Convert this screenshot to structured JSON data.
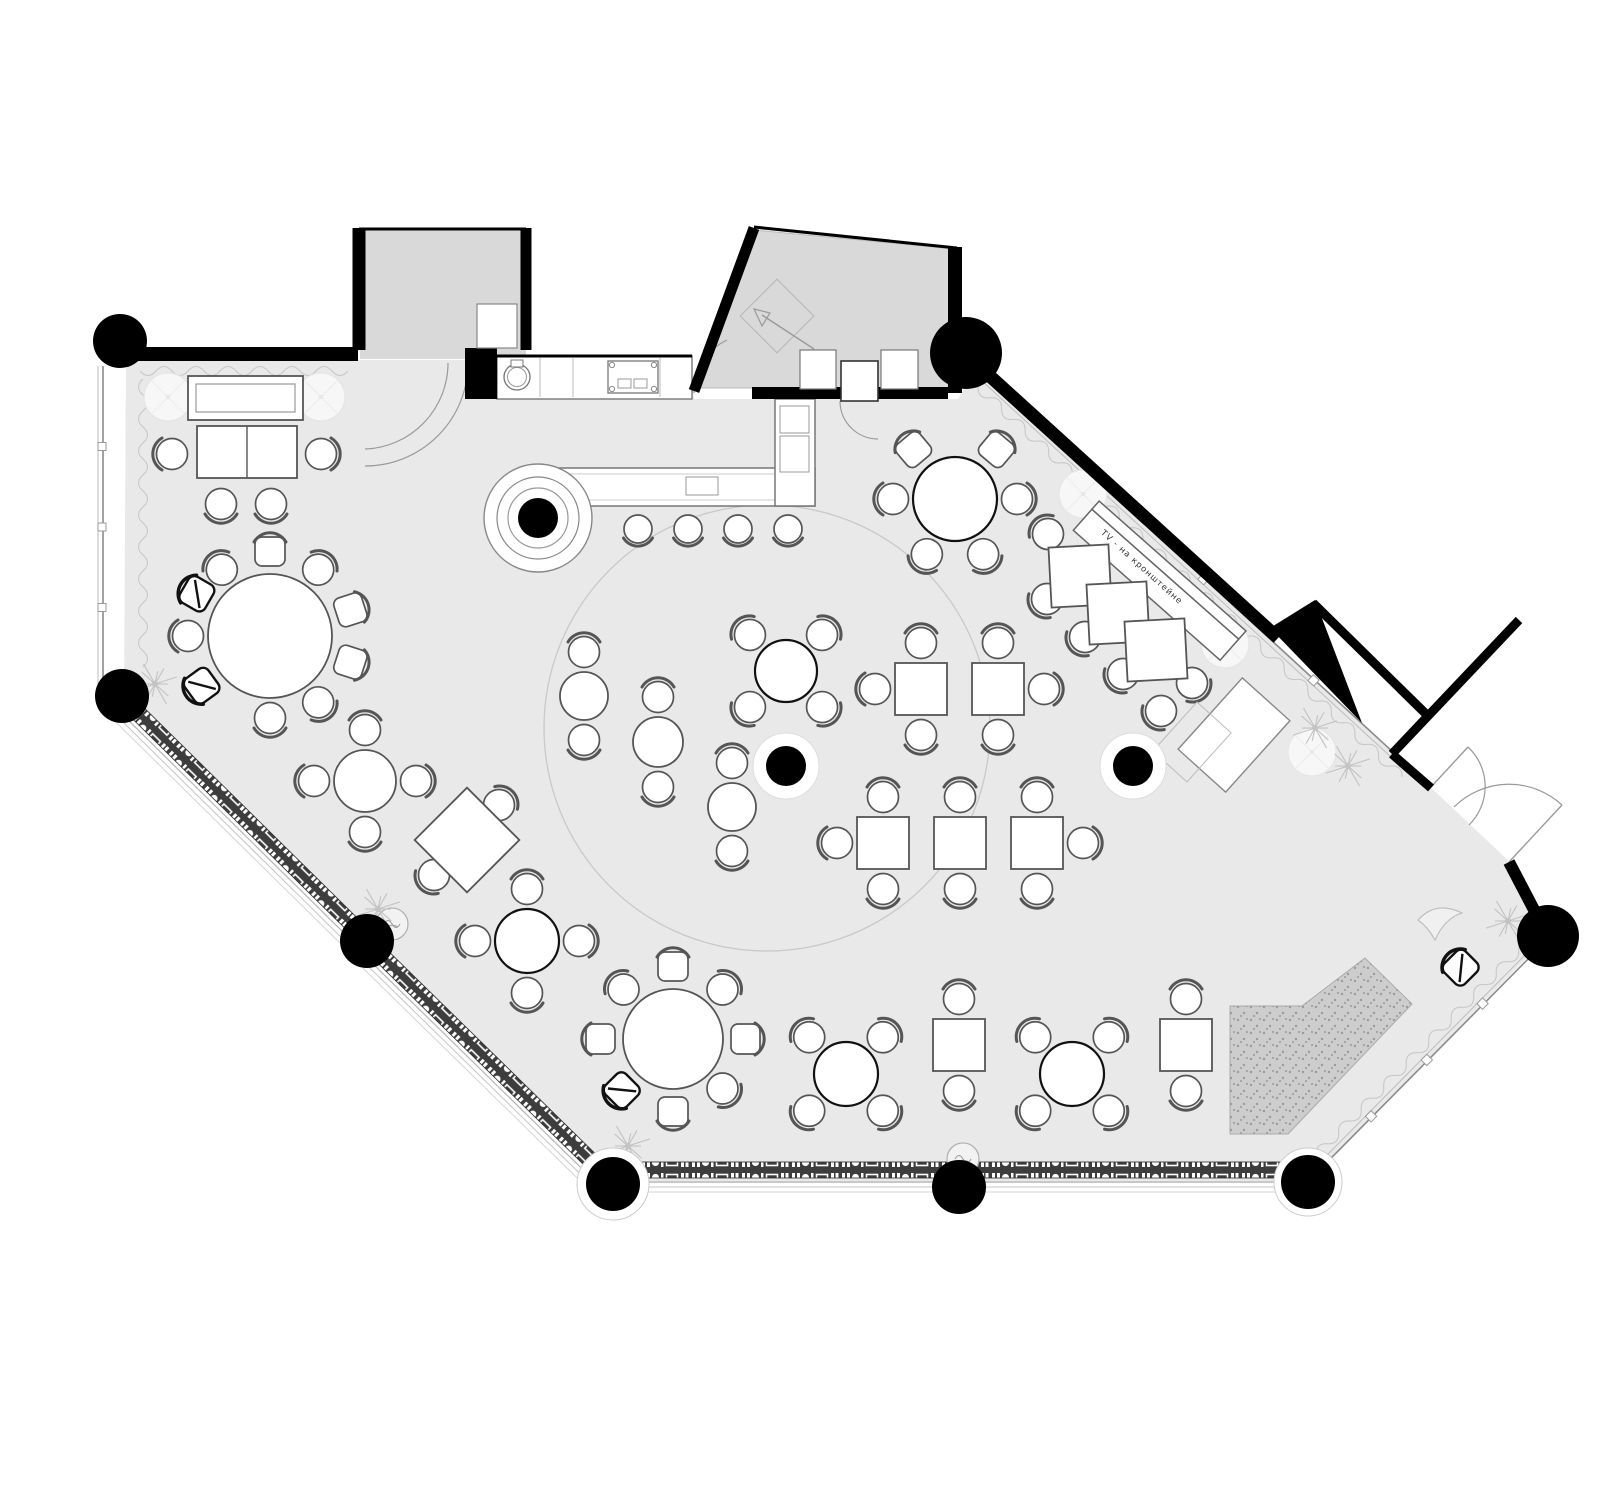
{
  "meta": {
    "title": "Restaurant floor plan",
    "canvas_w": 1600,
    "canvas_h": 1453
  },
  "labels": {
    "tv_mount": "TV - на кронштейне"
  },
  "colors": {
    "floor": "#e9e9e9",
    "recess": "#d9d9d9",
    "wall": "#000000",
    "stroke": "#555555",
    "bold_stroke": "#111111",
    "light": "#999999",
    "band_bg": "#3d3d3d",
    "stage_fill": "#cdcdcd",
    "stage_dot": "#9a9a9a",
    "dance": "#c9c9c9",
    "curtain": "#c8c8c8",
    "glass": "#8a8a8a",
    "faint": "#e5e5e5",
    "plant": "#c2c2c2"
  },
  "structure": {
    "floor_polygon": "86,344 652,344 654,383 918,383 938,350 1385,766 1472,848 1510,918 1268,1167 575,1167 84,678",
    "recess_alcove": "320,213 486,213 486,343 320,343",
    "recess_vestibule": "656,372 714,214 915,233 915,372",
    "walls": [
      [
        74,
        338,
        318,
        338,
        14
      ],
      [
        319,
        212,
        319,
        334,
        13
      ],
      [
        486,
        212,
        486,
        334,
        11
      ],
      [
        319,
        213,
        486,
        213,
        3
      ],
      [
        457,
        340,
        652,
        340,
        3
      ],
      [
        654,
        375,
        714,
        212,
        11
      ],
      [
        714,
        211,
        917,
        232,
        3
      ],
      [
        712,
        377,
        801,
        377,
        12
      ],
      [
        838,
        377,
        908,
        377,
        12
      ],
      [
        915,
        231,
        915,
        377,
        14
      ],
      [
        941,
        352,
        1238,
        622,
        13
      ],
      [
        1273,
        587,
        1386,
        698,
        9
      ],
      [
        1479,
        604,
        1352,
        738,
        9
      ],
      [
        1352,
        738,
        1391,
        772,
        9
      ],
      [
        1469,
        846,
        1503,
        911,
        12
      ]
    ],
    "wall_block": [
      425,
      332,
      32,
      51
    ],
    "wall_triangle": "1230,612 1275,584 1322,707",
    "columns": [
      [
        80,
        325,
        27
      ],
      [
        82,
        680,
        27
      ],
      [
        327,
        925,
        27
      ],
      [
        573,
        1168,
        27
      ],
      [
        919,
        1171,
        27
      ],
      [
        1268,
        1166,
        27
      ],
      [
        1508,
        920,
        31
      ],
      [
        926,
        337,
        36
      ]
    ],
    "ring_columns": [
      [
        746,
        750
      ],
      [
        1093,
        750
      ]
    ],
    "halo_columns": [
      [
        573,
        1168,
        36
      ],
      [
        1268,
        1166,
        34
      ]
    ],
    "glass": [
      {
        "x": 63,
        "y": 350,
        "angle": 90,
        "len": 322
      },
      {
        "x": 944,
        "y": 360,
        "angle": 42.6,
        "len": 598
      },
      {
        "x": 1499,
        "y": 932,
        "angle": 134.7,
        "len": 317
      }
    ],
    "curtains": [
      {
        "x": 100,
        "y": 355,
        "angle": 0,
        "len": 210
      },
      {
        "x": 103,
        "y": 363,
        "angle": 90,
        "len": 300
      },
      {
        "x": 938,
        "y": 371,
        "angle": 42.6,
        "len": 585
      },
      {
        "x": 1490,
        "y": 923,
        "angle": 134.7,
        "len": 310
      }
    ],
    "bands": [
      {
        "x": 600,
        "y": 1154,
        "angle": 0,
        "len": 645
      },
      {
        "x": 97,
        "y": 696,
        "angle": 44.6,
        "len": 303
      },
      {
        "x": 344,
        "y": 942,
        "angle": 44.4,
        "len": 295
      }
    ],
    "door_arcs": [
      {
        "d": "M428 347 A103 103 0 0 1 325 450"
      },
      {
        "d": "M408 347 A86 86 0 0 1 325 433"
      },
      {
        "d": "M654 377 A58 58 0 0 1 687 324"
      },
      {
        "d": "M800 385 A38 38 0 0 0 838 423"
      },
      {
        "d": "M1429 809 A54 54 0 0 0 1428 731",
        "leaf": [
          1391,
          771,
          1428,
          731
        ]
      },
      {
        "d": "M1414 791 A78 78 0 0 1 1522 789",
        "leaf": [
          1469,
          846,
          1522,
          789
        ]
      }
    ],
    "entry_mat": {
      "x": 737,
      "y": 300,
      "half": 26
    },
    "entry_arrow": {
      "line": [
        774,
        333,
        722,
        299
      ],
      "head": "714,293 730,297 722,310"
    },
    "door_leaf_rect": [
      801,
      345,
      37,
      40
    ],
    "benches": [
      [
        760,
        334,
        36,
        39
      ],
      [
        841,
        334,
        37,
        39
      ]
    ],
    "cabinet": [
      437,
      288,
      40,
      44
    ]
  },
  "furniture": {
    "round_tables": [
      {
        "x": 230,
        "y": 620,
        "r": 62,
        "bold": false,
        "seats": [
          [
            90,
            "s"
          ],
          [
            54,
            "c"
          ],
          [
            18,
            "s"
          ],
          [
            342,
            "s"
          ],
          [
            306,
            "c"
          ],
          [
            270,
            "c"
          ],
          [
            216,
            "b"
          ],
          [
            180,
            "c"
          ],
          [
            150,
            "b"
          ],
          [
            126,
            "c"
          ]
        ]
      },
      {
        "x": 915,
        "y": 483,
        "r": 42,
        "bold": true,
        "seats": [
          [
            130,
            "s"
          ],
          [
            50,
            "s"
          ],
          [
            180,
            "c"
          ],
          [
            0,
            "c"
          ],
          [
            243,
            "c"
          ],
          [
            297,
            "c"
          ]
        ]
      },
      {
        "x": 633,
        "y": 1023,
        "r": 50,
        "bold": false,
        "seats": [
          [
            90,
            "s"
          ],
          [
            45,
            "c"
          ],
          [
            0,
            "s"
          ],
          [
            315,
            "c"
          ],
          [
            270,
            "s"
          ],
          [
            225,
            "b"
          ],
          [
            180,
            "s"
          ],
          [
            135,
            "c"
          ]
        ]
      },
      {
        "x": 746,
        "y": 655,
        "r": 31,
        "bold": true,
        "seats": [
          [
            45,
            "c"
          ],
          [
            135,
            "c"
          ],
          [
            225,
            "c"
          ],
          [
            315,
            "c"
          ]
        ]
      },
      {
        "x": 806,
        "y": 1058,
        "r": 32,
        "bold": true,
        "seats": [
          [
            45,
            "c"
          ],
          [
            135,
            "c"
          ],
          [
            225,
            "c"
          ],
          [
            315,
            "c"
          ]
        ]
      },
      {
        "x": 1032,
        "y": 1058,
        "r": 32,
        "bold": true,
        "seats": [
          [
            45,
            "c"
          ],
          [
            135,
            "c"
          ],
          [
            225,
            "c"
          ],
          [
            315,
            "c"
          ]
        ]
      },
      {
        "x": 487,
        "y": 925,
        "r": 32,
        "bold": true,
        "seats": [
          [
            90,
            "c"
          ],
          [
            0,
            "c"
          ],
          [
            180,
            "c"
          ],
          [
            270,
            "c"
          ]
        ]
      },
      {
        "x": 325,
        "y": 765,
        "r": 31,
        "bold": false,
        "seats": [
          [
            90,
            "c"
          ],
          [
            0,
            "c"
          ],
          [
            180,
            "c"
          ],
          [
            270,
            "c"
          ]
        ]
      },
      {
        "x": 544,
        "y": 680,
        "r": 24,
        "bold": false,
        "seats": [
          [
            90,
            "c"
          ],
          [
            270,
            "c"
          ]
        ]
      },
      {
        "x": 618,
        "y": 726,
        "r": 25,
        "bold": false,
        "seats": [
          [
            90,
            "c"
          ],
          [
            270,
            "c"
          ]
        ]
      },
      {
        "x": 692,
        "y": 791,
        "r": 24,
        "bold": false,
        "seats": [
          [
            90,
            "c"
          ],
          [
            270,
            "c"
          ]
        ]
      }
    ],
    "square_tables": [
      {
        "x": 881,
        "y": 673,
        "w": 52,
        "seats": [
          "N",
          "W",
          "S"
        ]
      },
      {
        "x": 958,
        "y": 673,
        "w": 52,
        "seats": [
          "N",
          "E",
          "S"
        ]
      },
      {
        "x": 843,
        "y": 827,
        "w": 52,
        "seats": [
          "N",
          "W",
          "S"
        ]
      },
      {
        "x": 920,
        "y": 827,
        "w": 52,
        "seats": [
          "N",
          "S"
        ]
      },
      {
        "x": 997,
        "y": 827,
        "w": 52,
        "seats": [
          "N",
          "E",
          "S"
        ]
      },
      {
        "x": 919,
        "y": 1029,
        "w": 52,
        "seats": [
          "N",
          "S"
        ]
      },
      {
        "x": 1146,
        "y": 1029,
        "w": 52,
        "seats": [
          "N",
          "S"
        ]
      }
    ],
    "diamond_tables": [
      {
        "x": 427,
        "y": 824,
        "half": 37,
        "rot": 45,
        "chairs": [
          [
            459,
            789,
            225
          ],
          [
            394,
            859,
            45
          ]
        ]
      }
    ],
    "banquette": {
      "cx": 1114,
      "cy": 571,
      "angle": 41.5,
      "len": 196,
      "diamonds": [
        [
          1040,
          560
        ],
        [
          1078,
          597
        ],
        [
          1116,
          634
        ]
      ],
      "dhalf": 30,
      "drot": 87,
      "chairs": [
        [
          1008,
          518,
          138
        ],
        [
          1007,
          583,
          48
        ],
        [
          1045,
          621,
          48
        ],
        [
          1083,
          658,
          48
        ],
        [
          1121,
          695,
          48
        ],
        [
          1152,
          667,
          318
        ]
      ]
    },
    "sofa_zone": {
      "back": [
        148,
        360,
        115,
        44
      ],
      "back_inner": [
        156,
        368,
        99,
        28
      ],
      "table": [
        157,
        410,
        100,
        52
      ],
      "divider_x": 207,
      "chairs": [
        [
          132,
          438,
          90
        ],
        [
          281,
          438,
          270
        ],
        [
          181,
          488,
          0
        ],
        [
          231,
          488,
          0
        ]
      ]
    },
    "bar": {
      "counter": [
        500,
        452,
        275,
        38
      ],
      "counter_inner": [
        506,
        458,
        263,
        26
      ],
      "leg": [
        735,
        383,
        40,
        107
      ],
      "leg_shelves": [
        [
          740,
          390,
          29,
          27
        ],
        [
          740,
          420,
          29,
          36
        ]
      ],
      "tray": [
        646,
        461,
        32,
        18
      ],
      "column": {
        "x": 498,
        "y": 502,
        "rings": [
          54,
          41,
          30
        ],
        "core": 20
      },
      "stools": [
        [
          598,
          513
        ],
        [
          648,
          513
        ],
        [
          698,
          513
        ],
        [
          748,
          513
        ]
      ]
    },
    "kitchen": {
      "counter": [
        457,
        340,
        195,
        43
      ],
      "divisions": [
        500,
        533,
        620
      ],
      "sink": {
        "x": 477,
        "y": 361,
        "r": 13,
        "faucet": [
          471,
          344,
          12,
          7
        ]
      },
      "range": [
        568,
        345,
        50,
        32
      ]
    },
    "sideboards": [
      {
        "x": 1194,
        "y": 719,
        "w": 64,
        "h": 96,
        "rot": 42,
        "light": false
      },
      {
        "x": 1152,
        "y": 726,
        "w": 46,
        "h": 66,
        "rot": 42,
        "light": true
      }
    ],
    "stage": {
      "points": "1190,990 1262,990 1325,942 1372,988 1248,1118 1190,1118"
    },
    "dance_floor": {
      "x": 727,
      "y": 712,
      "r": 223
    },
    "plants": [
      [
        115,
        668
      ],
      [
        338,
        893
      ],
      [
        588,
        1130
      ],
      [
        1275,
        712
      ],
      [
        1308,
        750
      ],
      [
        1468,
        905
      ]
    ],
    "poufs": [
      [
        352,
        908
      ],
      [
        923,
        1143
      ]
    ],
    "lamps": [
      [
        128,
        381
      ],
      [
        281,
        381
      ],
      [
        1043,
        478
      ],
      [
        1185,
        628
      ],
      [
        1272,
        736
      ]
    ],
    "extra_chairs": [
      [
        1421,
        952,
        135,
        "b"
      ]
    ],
    "crescent": "M1378 904 Q1396 884 1422 897 Q1405 902 1395 924 Q1388 911 1378 904 Z"
  }
}
